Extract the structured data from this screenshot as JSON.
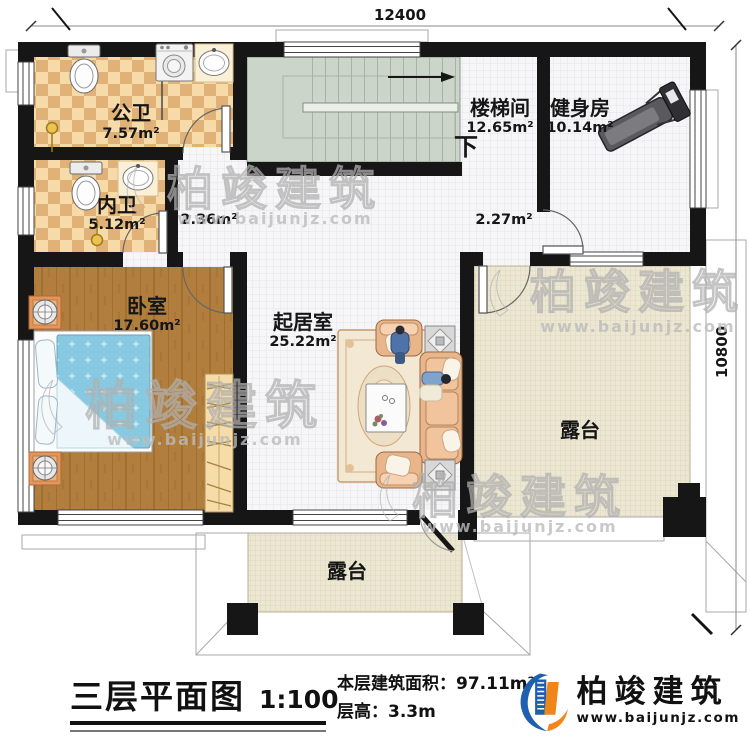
{
  "dimensions": {
    "top": "12400",
    "right": "10800"
  },
  "rooms": {
    "public_bath": {
      "name": "公卫",
      "area": "7.57m²"
    },
    "private_bath": {
      "name": "内卫",
      "area": "5.12m²"
    },
    "stairwell": {
      "name": "楼梯间",
      "area": "12.65m²"
    },
    "gym": {
      "name": "健身房",
      "area": "10.14m²"
    },
    "bedroom": {
      "name": "卧室",
      "area": "17.60m²"
    },
    "living": {
      "name": "起居室",
      "area": "25.22m²"
    },
    "terrace_right": {
      "name": "露台"
    },
    "terrace_bottom": {
      "name": "露台"
    },
    "hall_small": {
      "area": "2.36m²"
    },
    "hall_mid": {
      "area": "2.27m²"
    }
  },
  "stairs": {
    "down_label": "下"
  },
  "footer": {
    "plan_title": "三层平面图",
    "scale": "1:100",
    "area_line": "本层建筑面积：97.11m²",
    "height_line": "层高：3.3m"
  },
  "logo": {
    "name": "柏竣建筑",
    "url": "www.baijunjz.com"
  },
  "watermark": {
    "text": "柏竣建筑",
    "url": "www.baijunjz.com"
  },
  "colors": {
    "wall": "#161616",
    "bath_tile_light": "#f6dba9",
    "bath_tile_dark": "#e1b277",
    "wood_floor": "#b17e3d",
    "stair_fill": "#ccd5c9",
    "terrace_fill": "#ece7d3",
    "logo_blue": "#1f5fae",
    "logo_orange": "#f08519"
  }
}
